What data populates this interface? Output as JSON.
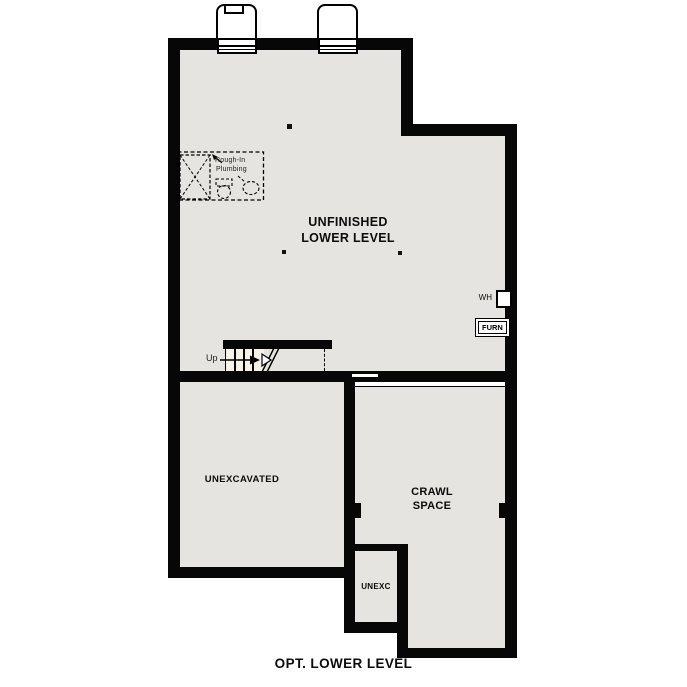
{
  "page": {
    "title": "OPT. LOWER LEVEL",
    "colors": {
      "background": "#ffffff",
      "floor_fill": "#e5e4e1",
      "wall": "#070707",
      "stair_fill": "#f6f2e9",
      "line": "#000000"
    }
  },
  "rooms": {
    "unfinished_lower_level": {
      "label_line1": "UNFINISHED",
      "label_line2": "LOWER LEVEL"
    },
    "unexcavated": {
      "label": "UNEXCAVATED"
    },
    "crawl_space": {
      "label_line1": "CRAWL",
      "label_line2": "SPACE"
    },
    "unexc": {
      "label": "UNEXC"
    }
  },
  "equipment": {
    "water_heater_label": "WH",
    "furnace_label": "FURN"
  },
  "stairs": {
    "up_label": "Up"
  },
  "plumbing": {
    "note_line1": "Rough-In",
    "note_line2": "Plumbing"
  },
  "footer": {
    "label": "OPT. LOWER LEVEL"
  }
}
